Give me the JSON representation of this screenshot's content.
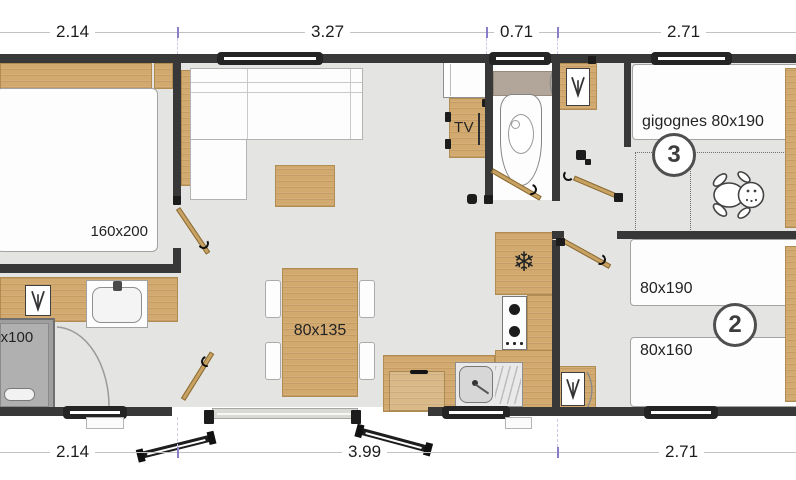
{
  "dimensions": {
    "top": [
      "2.14",
      "3.27",
      "0.71",
      "2.71"
    ],
    "bottom": [
      "2.14",
      "3.99",
      "2.71"
    ]
  },
  "labels": {
    "master_bed": "160x200",
    "shower": "80x100",
    "tv": "TV",
    "dining_table": "80x135",
    "bedroom3_beds": "gigognes 80x190",
    "bedroom3_number": "3",
    "bedroom2_bed_top": "80x190",
    "bedroom2_bed_bottom": "80x160",
    "bedroom2_number": "2"
  },
  "icons": {
    "fridge_glyph": "❄",
    "fridge": "snowflake-icon",
    "water_heater": "water-heater-icon",
    "baby": "baby-icon"
  },
  "colors": {
    "wood": "#d2aa70",
    "floor": "#e4e4e2",
    "wall": "#383838",
    "tick": "#8a7cc9"
  }
}
